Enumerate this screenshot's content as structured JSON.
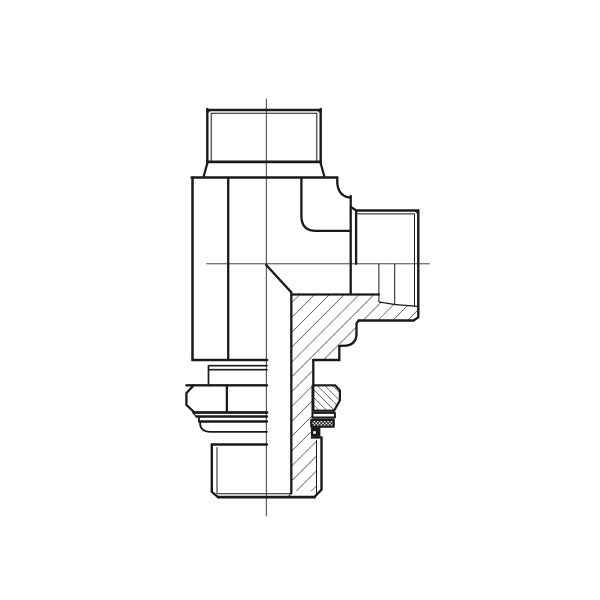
{
  "meta": {
    "description": "Technical CAD line drawing of a 90-degree adjustable male stud elbow hydraulic fitting shown in half-section: vertical male threaded port on top, horizontal male threaded port at right, and a bottom threaded stud with locknut, washer and ED-seal. Right/lower half is cross-hatched section.",
    "view": "half-section side view",
    "text_labels": []
  },
  "canvas": {
    "width": 600,
    "height": 600,
    "background": "#ffffff",
    "ink": "#1a1a1a",
    "centerline_color": "#2a2a2a"
  },
  "hatch": {
    "body_section_angle_deg": 45,
    "body_section_spacing": 10.5,
    "locknut_section_angle_deg": 135,
    "locknut_section_spacing": 5.4,
    "elastomer_crosshatch_spacing": 3.4
  },
  "drawing": {
    "parts": [
      {
        "name": "section-hatch-body",
        "paths": [
          {
            "d": "M291.3,294.5 H378.9 V301.9 L417.3,306.4 V317.3 L413.5,320.5 H358.7 L356.5,323.3 V334.5 Q355.8,344.9 345.2,345.7 L339.3,345.9 V360 H313.3 V438.7 H316.5 V491 H291.3 Z",
            "fill": "hatch45",
            "w": 0
          }
        ]
      },
      {
        "name": "centerlines",
        "paths": [
          {
            "d": "M266.3,99 V516",
            "w": 0.9,
            "stroke": "centerline"
          },
          {
            "d": "M206.5,263.8 H429.5",
            "w": 0.9,
            "stroke": "centerline"
          }
        ]
      },
      {
        "name": "top-port",
        "paths": [
          {
            "d": "M207.3,110 H320.7",
            "w": 2.4
          },
          {
            "d": "M207.3,109 V163.4 M320.7,109 V163.4",
            "w": 2.4
          },
          {
            "d": "M211.2,113.2 H316.8",
            "w": 1
          },
          {
            "d": "M211.2,113.2 V160.2 M316.8,113.2 V160.2",
            "w": 1
          },
          {
            "d": "M207.3,113.2 L211.2,109.8 M316.8,109.8 L320.7,113.2",
            "w": 1
          },
          {
            "d": "M207.3,161.9 H320.7",
            "w": 2.8
          },
          {
            "d": "M207.3,163.3 L203.7,176.3 M320.7,163.3 L324.3,176.3",
            "w": 2.2
          }
        ]
      },
      {
        "name": "body-block",
        "paths": [
          {
            "d": "M191.6,177.5 H337.3",
            "w": 2.5
          },
          {
            "d": "M192.5,177.5 V360",
            "w": 2.5
          },
          {
            "d": "M228.2,177.5 V359",
            "w": 2.3
          },
          {
            "d": "M192.5,360 H267",
            "w": 2.6
          },
          {
            "d": "M301.4,178 V216 Q301.4,230.9 316,230.9 H350.7",
            "w": 2.3
          },
          {
            "d": "M337.3,177.5 V183.5 Q338.8,196.8 350.7,197.6",
            "w": 2.3
          },
          {
            "d": "M350.7,196 V293",
            "w": 2.3
          },
          {
            "d": "M266.1,264.9 L291.3,292.3",
            "w": 2.3
          },
          {
            "d": "M291.3,292.3 V493.2",
            "w": 2.3
          },
          {
            "d": "M291.3,294.5 H378.9",
            "w": 2.3
          }
        ]
      },
      {
        "name": "right-port",
        "paths": [
          {
            "d": "M350.7,206.9 L356.3,210.5",
            "w": 2.3
          },
          {
            "d": "M356.3,210.5 H418.3",
            "w": 2.4
          },
          {
            "d": "M356.1,210.5 V263.8",
            "w": 2.3
          },
          {
            "d": "M418.3,210.5 V317.3",
            "w": 2.4
          },
          {
            "d": "M357.5,213.9 H414.4",
            "w": 1
          },
          {
            "d": "M414.5,213.9 V306.2",
            "w": 1
          },
          {
            "d": "M414.5,210.5 L418.3,214.2",
            "w": 1
          },
          {
            "d": "M418.3,317.3 L413.5,320.5",
            "w": 2.3
          },
          {
            "d": "M413.5,320.5 H358.7",
            "w": 2.4
          },
          {
            "d": "M378.9,263.8 V301.9",
            "w": 1
          },
          {
            "d": "M394.7,263.8 V303.8",
            "w": 1
          },
          {
            "d": "M378.9,301.9 L394.7,304.5 L417.3,306.4",
            "w": 1.3
          }
        ]
      },
      {
        "name": "body-lower-step-profile",
        "paths": [
          {
            "d": "M358.7,320.5 L356.5,323.3 V334.5 Q355.8,344.9 345.2,345.7 L339.3,345.9 V360",
            "w": 2.3
          },
          {
            "d": "M339.3,360 H313.3",
            "w": 2.6
          },
          {
            "d": "M313.3,360 V385.3",
            "w": 2.3
          },
          {
            "d": "M312,385.3 V417.6",
            "w": 1
          }
        ]
      },
      {
        "name": "washer",
        "paths": [
          {
            "d": "M208.5,365.7 H267",
            "w": 1.7
          },
          {
            "d": "M208.5,369.7 H267",
            "w": 1.7
          },
          {
            "d": "M208.5,365.7 V385.3",
            "w": 1.7
          }
        ]
      },
      {
        "name": "locknut",
        "paths": [
          {
            "d": "M186.4,385.3 H267",
            "w": 2.4
          },
          {
            "d": "M193.6,385.3 L186.4,393.1 V404.9 L193.6,411.7",
            "w": 2.3
          },
          {
            "d": "M226.9,385.3 V411.7",
            "w": 2.3
          },
          {
            "d": "M193.6,412.5 H267",
            "w": 2.8
          }
        ]
      },
      {
        "name": "locknut-section",
        "paths": [
          {
            "d": "M313.3,385.3 H335.1 L339.9,390.5 V400.3 L334.1,410.7 H313.3 Z",
            "fill": "#ffffff",
            "w": 0
          },
          {
            "d": "M313.3,385.3 H335.1 L339.9,390.5 V400.3 L334.1,410.7 H313.3 Z",
            "fill": "hatch135",
            "w": 2.2
          }
        ]
      },
      {
        "name": "ed-seal-left",
        "paths": [
          {
            "d": "M193.4,413.4 L196.3,416.5",
            "w": 1.2
          },
          {
            "d": "M196.3,416.5 H267",
            "w": 2.4
          },
          {
            "d": "M199,416.5 V421.5",
            "w": 1.8
          },
          {
            "d": "M199,421.5 H267",
            "w": 2.4
          },
          {
            "d": "M200.1,423 Q200.1,431.9 211.2,431.9 H267",
            "w": 1.8
          },
          {
            "d": "M211.8,444.5 H267",
            "w": 2.4
          }
        ]
      },
      {
        "name": "ed-seal-section",
        "paths": [
          {
            "d": "M312.5,412.9 H334.9 V417.5 H312.5 Z",
            "fill": "#ffffff",
            "w": 2
          },
          {
            "d": "M311.3,419.9 H333.7 V426.7 H311.3 Z",
            "fill": "#ffffff",
            "w": 0
          },
          {
            "d": "M311.3,419.9 H333.7 V426.7 H311.3 Z",
            "fill": "crosshatch",
            "w": 2.2
          },
          {
            "d": "M311.5,427.9 H319.9 V435.9 H311.5 Z",
            "fill": "ink",
            "w": 1
          },
          {
            "d": "M313.2,431.2 h2.6 v2.6 h-2.6 Z",
            "fill": "#ffffff",
            "w": 0
          },
          {
            "d": "M311.7,437.5 H321.5",
            "w": 2.2
          }
        ]
      },
      {
        "name": "stud-thread",
        "paths": [
          {
            "d": "M211.8,444.5 V491.7",
            "w": 2.4
          },
          {
            "d": "M217,447.5 V493.7",
            "w": 1
          },
          {
            "d": "M321.5,437.5 V489.7",
            "w": 2.4
          },
          {
            "d": "M316.5,440.2 V493.7",
            "w": 1
          },
          {
            "d": "M211.8,491.7 L218,497.1",
            "w": 2.3
          },
          {
            "d": "M321.5,489.7 L314.7,496.7",
            "w": 2.3
          },
          {
            "d": "M218,497.1 H314.7",
            "w": 2.7
          },
          {
            "d": "M218,493.7 H291",
            "w": 1
          },
          {
            "d": "M291.3,493.2 L288.2,496.9",
            "w": 1
          }
        ]
      }
    ]
  }
}
